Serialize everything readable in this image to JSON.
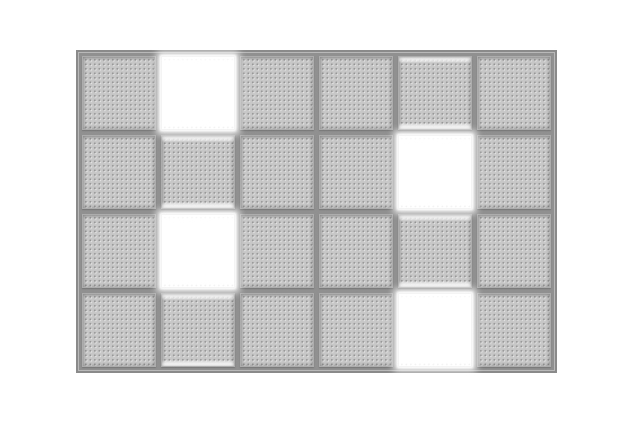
{
  "scene": {
    "description": "4x6 grid of gray perforated panels in a gray frame; four panels are lit white with a glow"
  },
  "grid": {
    "rows": 4,
    "cols": 6,
    "tiles": [
      [
        "panel",
        "lit",
        "panel",
        "panel",
        "panel-leak",
        "panel"
      ],
      [
        "panel",
        "panel-leak",
        "panel",
        "panel",
        "lit",
        "panel"
      ],
      [
        "panel",
        "lit",
        "panel",
        "panel",
        "panel-leak",
        "panel"
      ],
      [
        "panel",
        "panel-leak",
        "panel",
        "panel",
        "lit",
        "panel"
      ]
    ],
    "lit_tiles": [
      {
        "row": 1,
        "col": 2
      },
      {
        "row": 2,
        "col": 5
      },
      {
        "row": 3,
        "col": 2
      },
      {
        "row": 4,
        "col": 5
      }
    ],
    "states_legend": {
      "panel": "gray perforated tile",
      "lit": "white glowing tile",
      "panel-leak": "gray tile with white light leaking at its top and bottom edges"
    }
  },
  "colors": {
    "page_bg": "#ffffff",
    "frame_bg": "#909090",
    "frame_border": "#8a8a8a",
    "frame_highlight": "#b9b9b9",
    "tile_face": "#c7c7c7",
    "tile_edge": "#adadad",
    "dot_dark": "#949494",
    "dot_light": "#e2e2e2",
    "lit_color": "#ffffff"
  }
}
